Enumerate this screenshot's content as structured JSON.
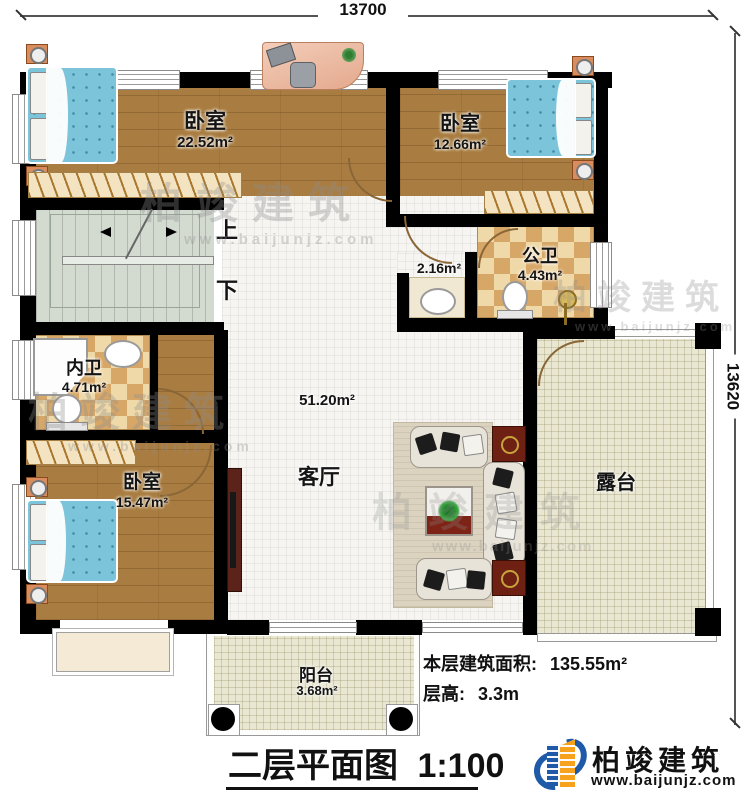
{
  "dimensions": {
    "width_label": "13700",
    "height_label": "13620"
  },
  "rooms": {
    "bedroom_top_left": {
      "name": "卧室",
      "area": "22.52m²"
    },
    "bedroom_top_right": {
      "name": "卧室",
      "area": "12.66m²"
    },
    "bedroom_bottom_left": {
      "name": "卧室",
      "area": "15.47m²"
    },
    "inner_bathroom": {
      "name": "内卫",
      "area": "4.71m²"
    },
    "public_bathroom": {
      "name": "公卫",
      "area": "4.43m²"
    },
    "hall": {
      "area": "2.16m²"
    },
    "living_room": {
      "name": "客厅",
      "area": "51.20m²"
    },
    "terrace": {
      "name": "露台"
    },
    "balcony": {
      "name": "阳台",
      "area": "3.68m²"
    }
  },
  "stairs": {
    "up": "上",
    "down": "下"
  },
  "footer": {
    "floor_area_label": "本层建筑面积:",
    "floor_area_value": "135.55m²",
    "floor_height_label": "层高:",
    "floor_height_value": "3.3m",
    "title": "二层平面图",
    "scale": "1:100"
  },
  "logo": {
    "name": "柏竣建筑",
    "url": "www.baijunjz.com"
  },
  "watermark": {
    "text": "柏竣建筑",
    "url": "www.baijunjz.com"
  },
  "colors": {
    "wall": "#000000",
    "wood": "#a97d41",
    "tile_light": "#f0d9a8",
    "tile_dark": "#d7a768",
    "bed": "#7cc4da",
    "stairs": "#d3dad0",
    "terrace": "#e9e7d2",
    "logo_blue": "#1e5aa8",
    "logo_orange": "#f6a21d",
    "watermark_gray": "#8e8e8e"
  }
}
